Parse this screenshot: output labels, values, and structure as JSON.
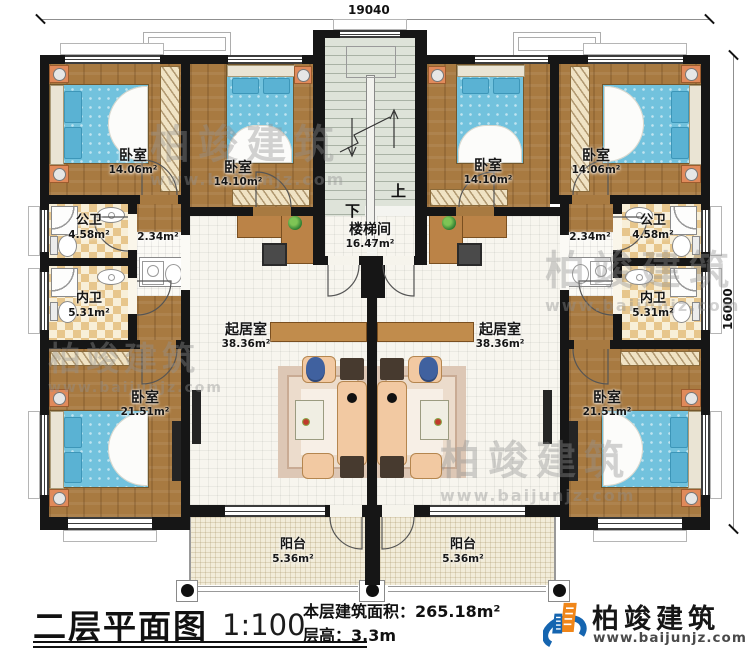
{
  "dimensions": {
    "top": "19040",
    "right": "16000"
  },
  "stairwell": {
    "label": "楼梯间",
    "area": "16.47m²",
    "up": "上",
    "down": "下"
  },
  "rooms": {
    "bedroom_tl1": {
      "label": "卧室",
      "area": "14.06m²"
    },
    "bedroom_tl2": {
      "label": "卧室",
      "area": "14.10m²"
    },
    "bedroom_tr1": {
      "label": "卧室",
      "area": "14.10m²"
    },
    "bedroom_tr2": {
      "label": "卧室",
      "area": "14.06m²"
    },
    "bath_public_left": {
      "label": "公卫",
      "area": "4.58m²"
    },
    "bath_private_left": {
      "label": "内卫",
      "area": "5.31m²"
    },
    "bath_public_right": {
      "label": "公卫",
      "area": "4.58m²"
    },
    "bath_private_right": {
      "label": "内卫",
      "area": "5.31m²"
    },
    "hall_left": {
      "area": "2.34m²"
    },
    "hall_right": {
      "area": "2.34m²"
    },
    "living_left": {
      "label": "起居室",
      "area": "38.36m²"
    },
    "living_right": {
      "label": "起居室",
      "area": "38.36m²"
    },
    "bedroom_bl": {
      "label": "卧室",
      "area": "21.51m²"
    },
    "bedroom_br": {
      "label": "卧室",
      "area": "21.51m²"
    },
    "balcony_left": {
      "label": "阳台",
      "area": "5.36m²"
    },
    "balcony_right": {
      "label": "阳台",
      "area": "5.36m²"
    }
  },
  "titleblock": {
    "title": "二层平面图",
    "scale": "1:100",
    "area_line": "本层建筑面积：265.18m²",
    "height_line": "层高：3.3m"
  },
  "brand": {
    "name": "柏竣建筑",
    "url": "www.baijunjz.com"
  },
  "watermark": {
    "name": "柏竣建筑",
    "url": "www.baijunjz.com"
  },
  "colors": {
    "wall": "#161616",
    "wood": "#a87a41",
    "brand_blue": "#1565b0",
    "brand_orange": "#f08619"
  }
}
